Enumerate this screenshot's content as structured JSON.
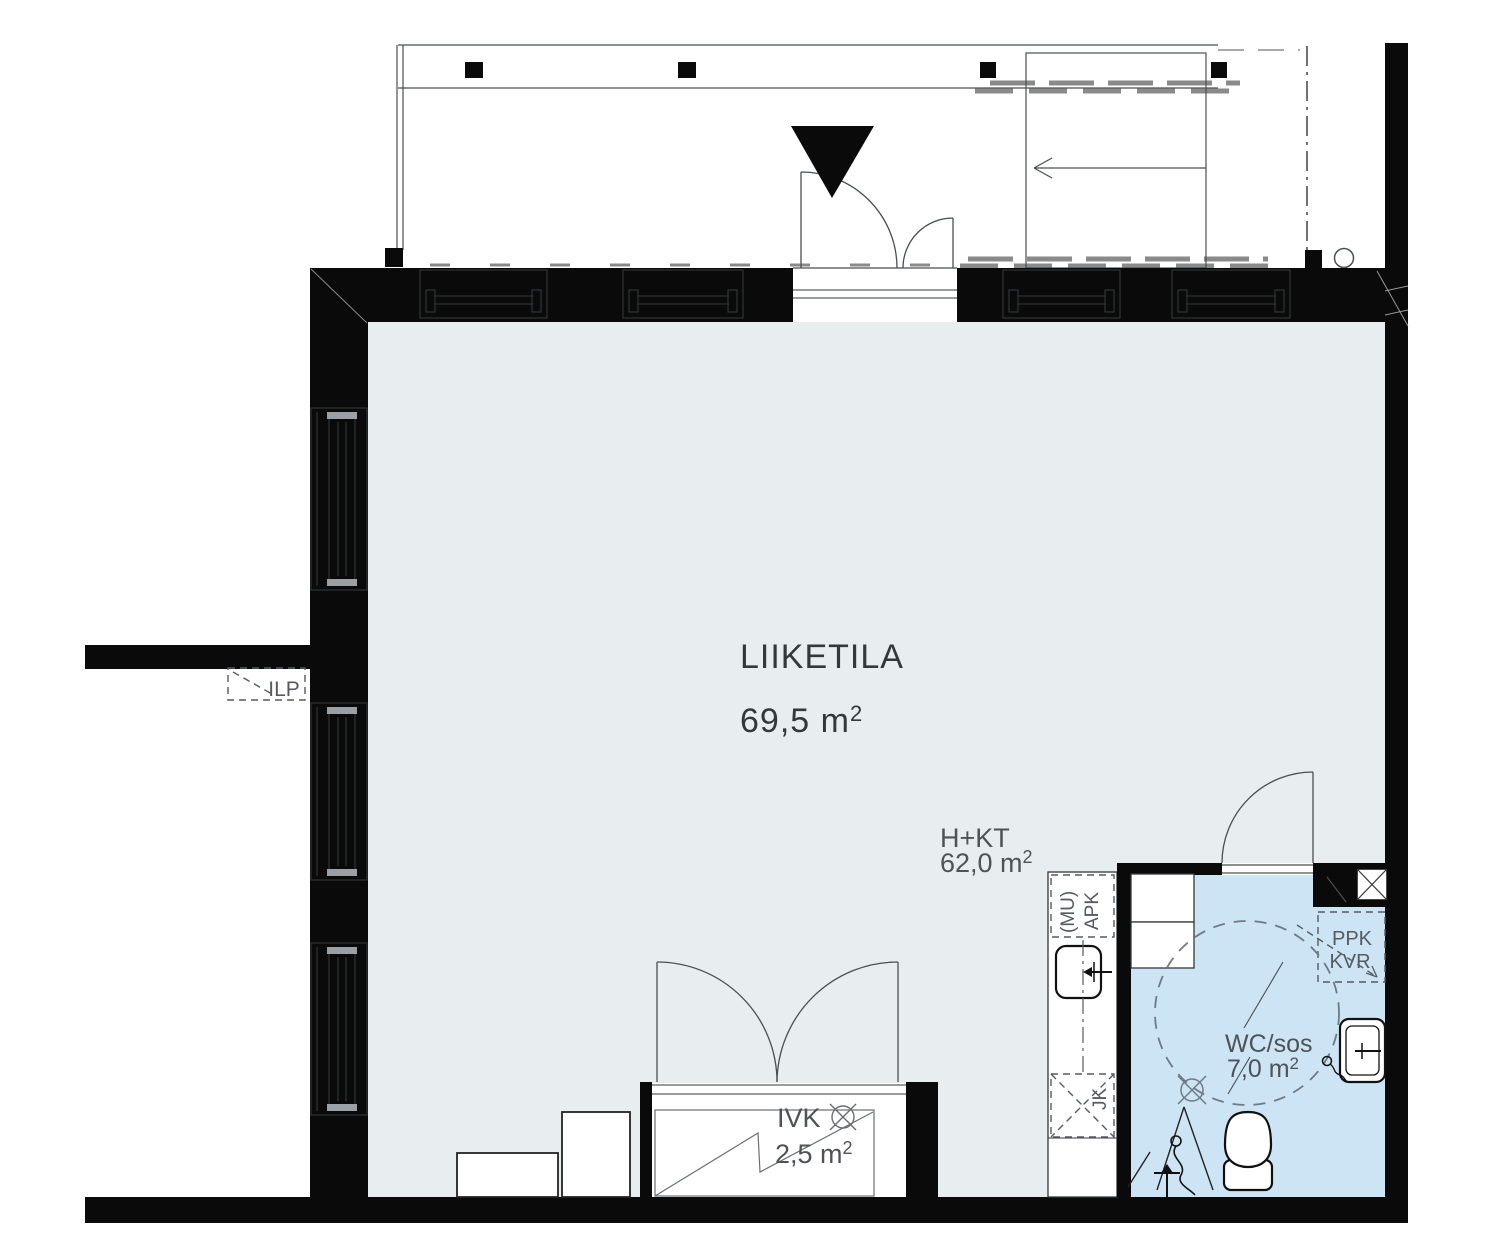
{
  "drawing": {
    "rooms": {
      "liiketila": {
        "name": "LIIKETILA",
        "area": "69,5 m",
        "area_sup": "2"
      },
      "h_kt": {
        "name": "H+KT",
        "area": "62,0 m",
        "area_sup": "2"
      },
      "wc": {
        "name": "WC/sos",
        "area": "7,0 m",
        "area_sup": "2"
      },
      "ivk": {
        "name": "IVK",
        "area": "2,5 m",
        "area_sup": "2"
      }
    },
    "annotations": {
      "ilp": "ILP",
      "ppk": "PPK",
      "kvr": "KVR",
      "mu": "(MU)",
      "apk": "APK",
      "jk": "JK"
    },
    "colors": {
      "wall": "#0a0a0a",
      "main_floor": "#e8edef",
      "wc_floor": "#cde4f4"
    }
  }
}
